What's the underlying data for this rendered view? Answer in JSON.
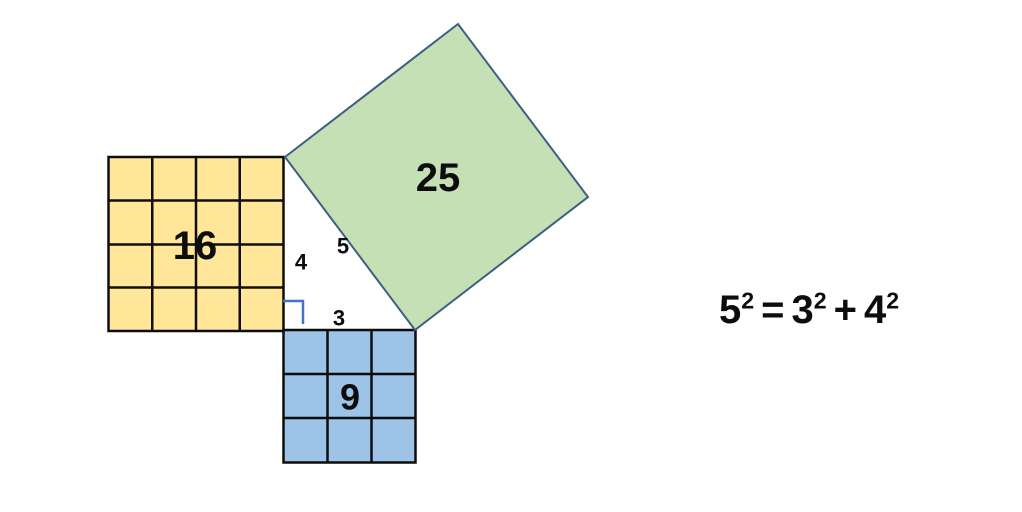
{
  "slide": {
    "background": "#ffffff"
  },
  "diagram": {
    "squares": [
      {
        "label": "16",
        "fill": "#ffe699",
        "grid": "4x4"
      },
      {
        "label": "25",
        "fill": "#c5e0b4",
        "grid": "none"
      },
      {
        "label": "9",
        "fill": "#9dc3e6",
        "grid": "3x3"
      }
    ],
    "side_labels": {
      "vertical_leg": "4",
      "hypotenuse": "5",
      "horizontal_leg": "3"
    },
    "colors": {
      "grid_stroke": "#0d0d0d",
      "tilted_square_stroke": "#3c5f84",
      "right_angle_marker": "#4472c4"
    }
  },
  "equation": {
    "full_text": "5² = 3² + 4²",
    "term1_base": "5",
    "term1_exp": "2",
    "equals_sign": "=",
    "term2_base": "3",
    "term2_exp": "2",
    "plus_sign": "+",
    "term3_base": "4",
    "term3_exp": "2"
  }
}
